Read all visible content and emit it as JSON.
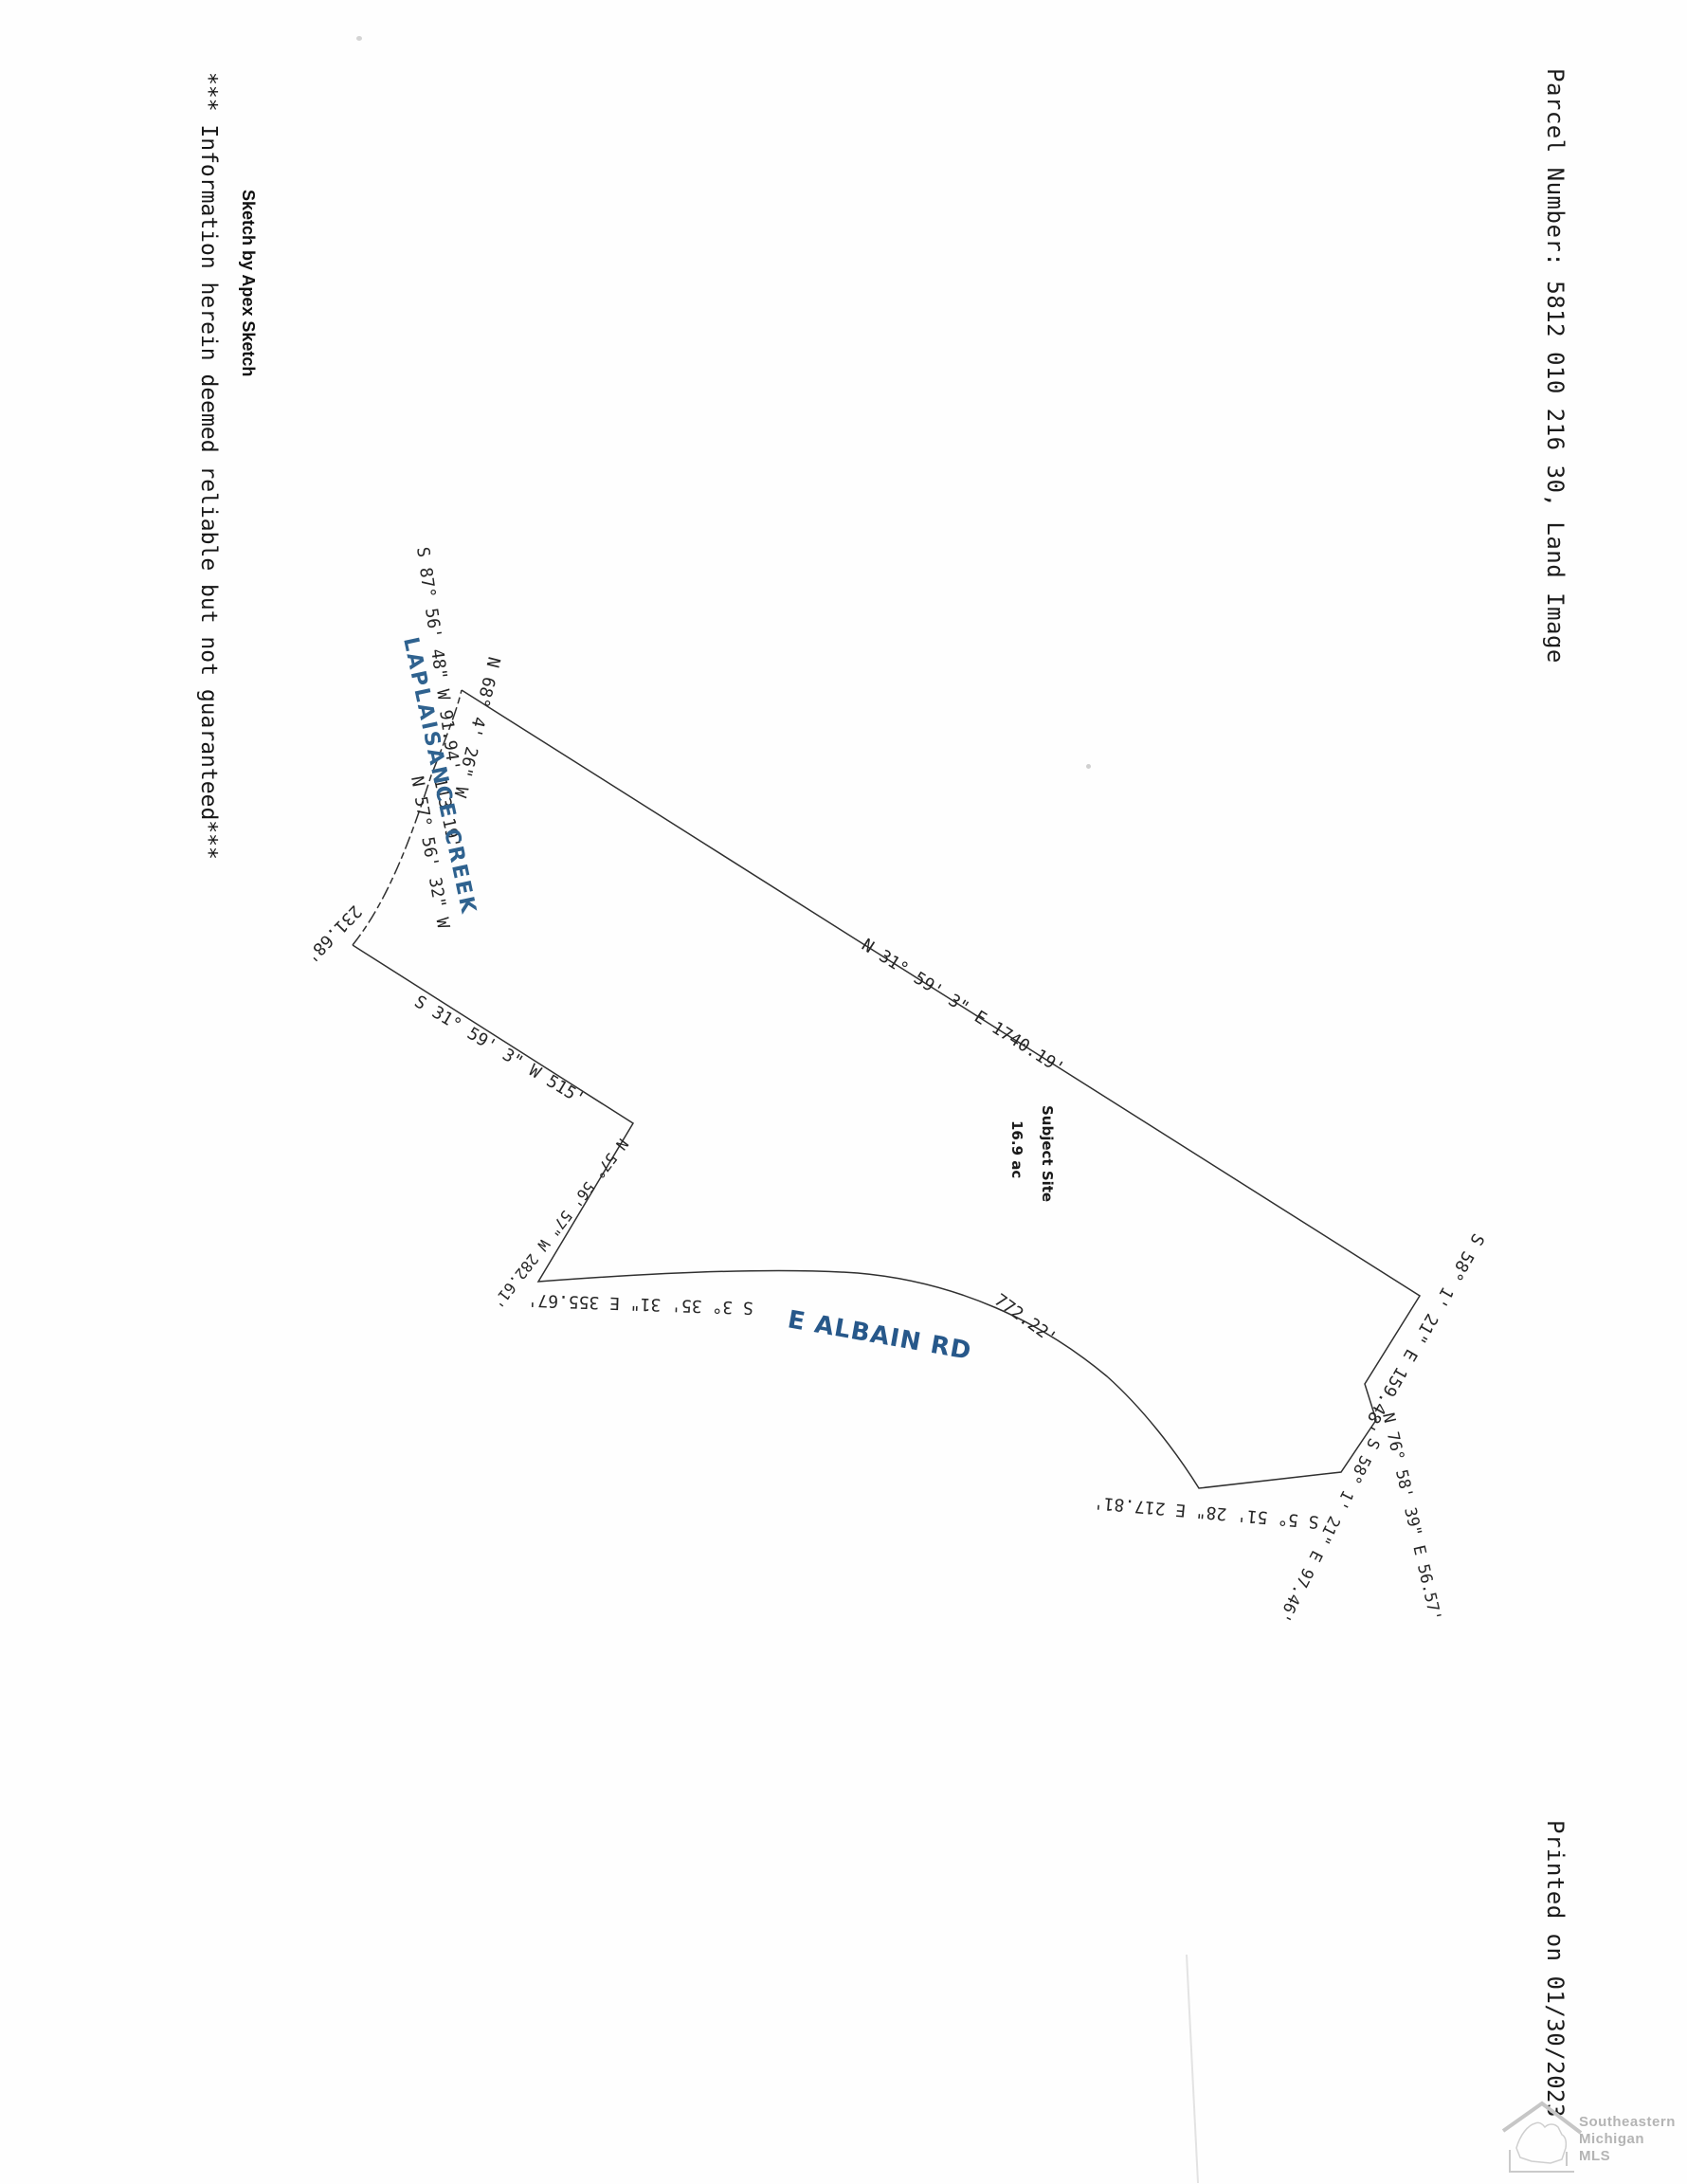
{
  "page": {
    "header": "Parcel Number:  5812 010 216 30,  Land Image",
    "footer": "Printed on  01/30/2023",
    "disclaimer": "*** Information herein deemed reliable but not guaranteed***",
    "credit": "Sketch by Apex Sketch"
  },
  "sketch": {
    "site_label": "Subject Site",
    "site_area": "16.9 ac",
    "creek_name": "LAPLAISANCE CREEK",
    "road_name": "E ALBAIN RD",
    "bearings": {
      "east_main": "N 31° 59' 3\" E 1740.19'",
      "creek_1": "S 87° 56' 48\" W 91.94'",
      "creek_2": "N 68° 4' 26\" W",
      "creek_3_dist": "113.19'",
      "creek_3": "N 57° 56' 32\" W",
      "creek_4_dist": "231.68'",
      "south_515": "S 31° 59' 3\" W 515'",
      "west_282": "N 57° 56' 57\" W 282.61'",
      "south_355": "S 3° 35' 31\" E 355.67'",
      "road_dist": "772.22'",
      "se_159": "S 58° 1' 21\" E 159.48'",
      "se_97": "S 58° 1' 21\" E 97.46'",
      "ne_56": "N 76° 58' 39\" E 56.57'",
      "se_217": "S 5° 51' 28\" E 217.81'"
    }
  },
  "logo": {
    "line1": "Southeastern",
    "line2": "Michigan",
    "line3": "MLS"
  },
  "colors": {
    "ink": "#262626",
    "creek_blue": "#2f628f",
    "road_blue": "#27588a",
    "logo_gray": "#b4b4b4"
  }
}
